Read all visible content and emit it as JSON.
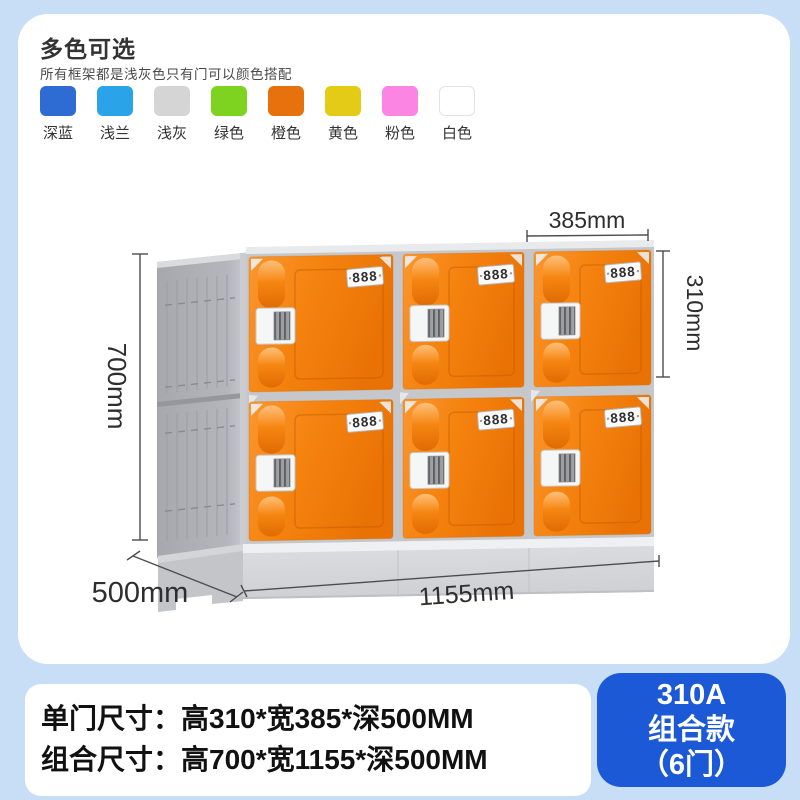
{
  "colors": {
    "bg": "#C7DEF6",
    "cardBg": "#FFFFFF",
    "badgeBlue": "#1C59D6",
    "doorLight": "#FB9630",
    "doorMain": "#F5830F",
    "doorDark": "#EA7205",
    "pillLight": "#FFC07A",
    "pillMid": "#F68612",
    "pillDark": "#E06B03",
    "frameLight": "#C9CACF",
    "frameMid": "#B5B6BC",
    "frameDark": "#A7A8AE",
    "baseLight": "#EFF0F2",
    "baseMid": "#DADBDE",
    "baseDark": "#CFD0D4",
    "dimLine": "#4D4D4D",
    "dimText": "#2E2E2E",
    "headingText": "#333333",
    "specText": "#111111"
  },
  "header": {
    "title": "多色可选",
    "subtitle": "所有框架都是浅灰色只有门可以颜色搭配",
    "swatches": [
      {
        "label": "深蓝",
        "color": "#2E6BD3"
      },
      {
        "label": "浅兰",
        "color": "#2BA3E9"
      },
      {
        "label": "浅灰",
        "color": "#D5D5D6"
      },
      {
        "label": "绿色",
        "color": "#7ED321"
      },
      {
        "label": "橙色",
        "color": "#E7710D"
      },
      {
        "label": "黄色",
        "color": "#E4CC16"
      },
      {
        "label": "粉色",
        "color": "#FB85E3"
      },
      {
        "label": "白色",
        "color": "#FFFFFF"
      }
    ]
  },
  "diagram": {
    "door_label": "888",
    "dims": {
      "single_width": "385mm",
      "single_height": "310mm",
      "total_height": "700mm",
      "depth": "500mm",
      "total_width": "1155mm"
    }
  },
  "specs": {
    "line1": "单门尺寸：高310*宽385*深500MM",
    "line2": "组合尺寸：高700*宽1155*深500MM"
  },
  "badge": {
    "line1": "310A",
    "line2": "组合款",
    "line3": "（6门）"
  }
}
